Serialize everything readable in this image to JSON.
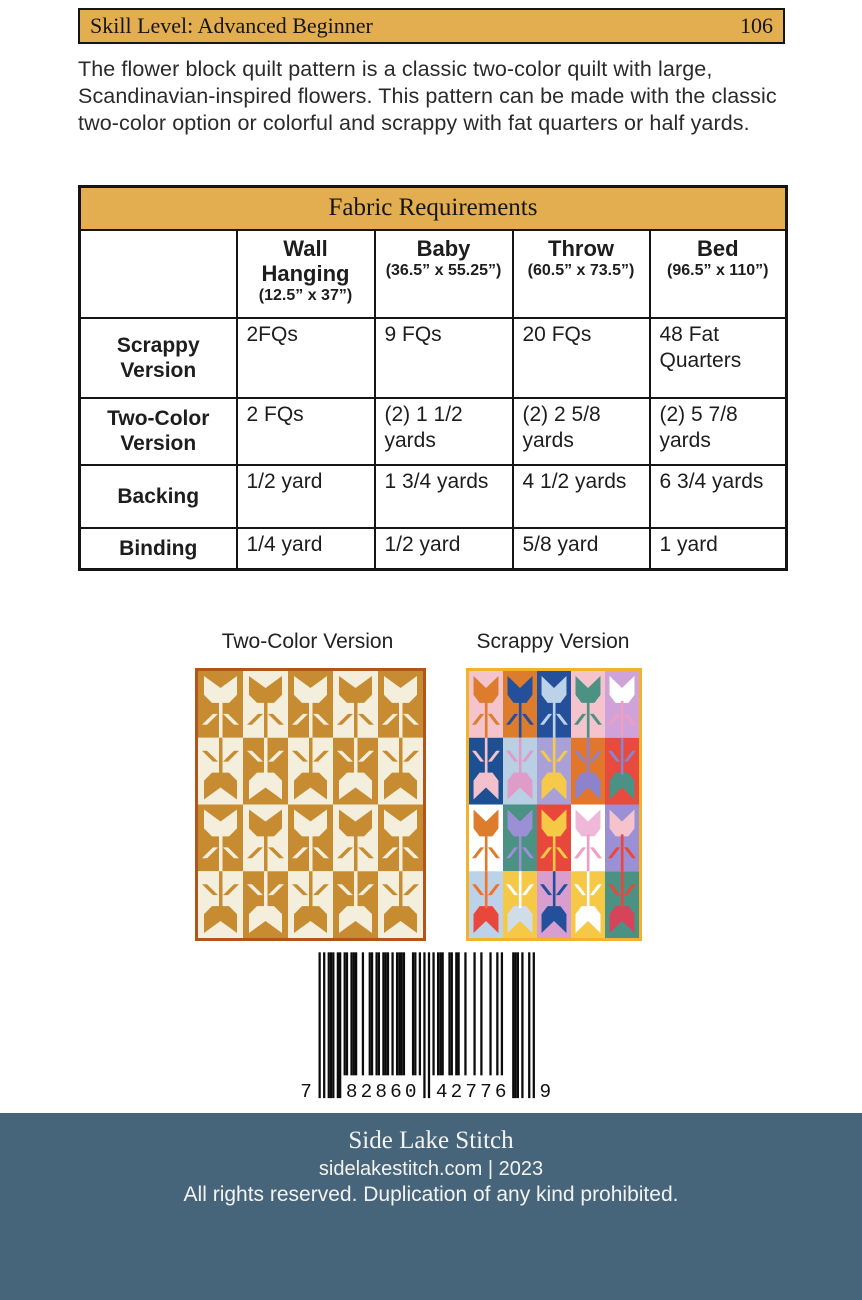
{
  "header_bar": {
    "skill_label": "Skill Level: Advanced Beginner",
    "page_number": "106",
    "bg": "#e3ae50"
  },
  "description": "The flower block quilt pattern is a classic two-color quilt with large, Scandinavian-inspired flowers. This pattern can be made with the classic two-color option or colorful and scrappy with fat quarters or half yards.",
  "fabric_table": {
    "title": "Fabric Requirements",
    "columns": [
      {
        "name": "Wall Hanging",
        "size": "(12.5” x 37”)"
      },
      {
        "name": "Baby",
        "size": "(36.5” x 55.25”)"
      },
      {
        "name": "Throw",
        "size": "(60.5” x 73.5”)"
      },
      {
        "name": "Bed",
        "size": "(96.5” x 110”)"
      }
    ],
    "rows": [
      {
        "label": "Scrappy Version",
        "values": [
          "2FQs",
          "9 FQs",
          "20 FQs",
          "48 Fat Quarters"
        ]
      },
      {
        "label": "Two-Color Version",
        "values": [
          "2 FQs",
          "(2) 1 1/2 yards",
          "(2) 2 5/8 yards",
          "(2) 5 7/8 yards"
        ]
      },
      {
        "label": "Backing",
        "values": [
          "1/2 yard",
          "1 3/4 yards",
          "4 1/2 yards",
          "6 3/4 yards"
        ]
      },
      {
        "label": "Binding",
        "values": [
          "1/4 yard",
          "1/2 yard",
          "5/8 yard",
          "1 yard"
        ]
      }
    ]
  },
  "quilts": {
    "two_color": {
      "label": "Two-Color Version",
      "border_color": "#b2551b",
      "gold": "#c78c31",
      "cream": "#f4efdd"
    },
    "scrappy": {
      "label": "Scrappy Version",
      "border_color": "#f2b32c",
      "blocks": [
        {
          "bg": "#f4c3cb",
          "flower": "#dd7c2c",
          "stem": "#dd7c2c"
        },
        {
          "bg": "#dd7c2c",
          "flower": "#24509b",
          "stem": "#24509b"
        },
        {
          "bg": "#24509b",
          "flower": "#bcd2e8",
          "stem": "#bcd2e8"
        },
        {
          "bg": "#f4c3cb",
          "flower": "#4b9184",
          "stem": "#4b9184"
        },
        {
          "bg": "#cfa3da",
          "flower": "#ffffff",
          "stem": "#ef9ec2"
        },
        {
          "bg": "#1d4f93",
          "flower": "#f3c1cb",
          "stem": "#f3c1cb"
        },
        {
          "bg": "#b9cfe3",
          "flower": "#df9cc8",
          "stem": "#df9cc8"
        },
        {
          "bg": "#a9a0d8",
          "flower": "#f6c94b",
          "stem": "#f6c94b"
        },
        {
          "bg": "#e2762a",
          "flower": "#8d82cc",
          "stem": "#8d82cc"
        },
        {
          "bg": "#e84a3e",
          "flower": "#4b9184",
          "stem": "#8d82cc"
        },
        {
          "bg": "#ffffff",
          "flower": "#dd7c2c",
          "stem": "#dd7c2c"
        },
        {
          "bg": "#4b9184",
          "flower": "#9b8fd6",
          "stem": "#9b8fd6"
        },
        {
          "bg": "#e8483c",
          "flower": "#f5c945",
          "stem": "#f5c945"
        },
        {
          "bg": "#ffffff",
          "flower": "#f0b8d8",
          "stem": "#ef9ec2"
        },
        {
          "bg": "#9b8fd6",
          "flower": "#f4c3cb",
          "stem": "#e8483c"
        },
        {
          "bg": "#bcd2e8",
          "flower": "#e8483c",
          "stem": "#ee7330"
        },
        {
          "bg": "#f5c945",
          "flower": "#cfdde9",
          "stem": "#ffffff"
        },
        {
          "bg": "#d99ed0",
          "flower": "#24509b",
          "stem": "#24509b"
        },
        {
          "bg": "#f5c945",
          "flower": "#ffffff",
          "stem": "#ffffff"
        },
        {
          "bg": "#4b9184",
          "flower": "#d6445c",
          "stem": "#e8483c"
        }
      ]
    }
  },
  "barcode": {
    "digits": "782860427769",
    "display": [
      "7",
      "82860",
      "42776",
      "9"
    ]
  },
  "footer": {
    "bg": "#46647a",
    "title": "Side Lake Stitch",
    "site": "sidelakestitch.com | 2023",
    "rights": "All rights reserved. Duplication of any kind prohibited."
  }
}
